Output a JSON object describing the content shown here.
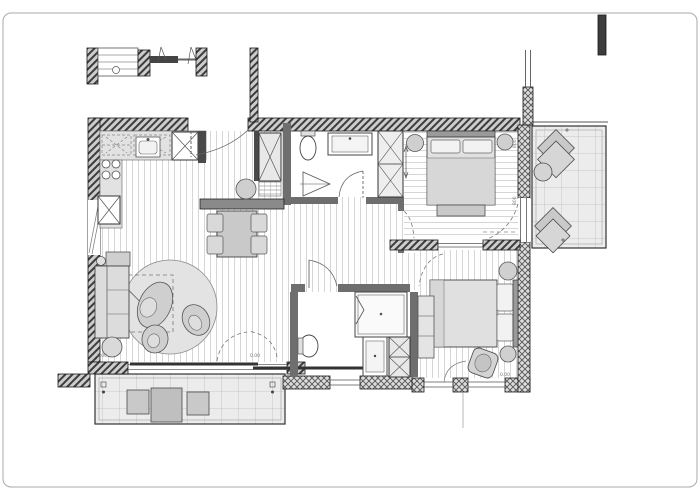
{
  "meta": {
    "drawing_type": "apartment floor plan",
    "sheet": {
      "border_color": "#aaaaaa",
      "background": "#ffffff"
    }
  },
  "palette": {
    "wall_hatch_dark": "#3d3d3d",
    "wall_hatch_bg": "#cdcdcd",
    "wall_interior": "#6e6e6e",
    "wall_outline": "#1a1a1a",
    "floor_stripe": "#d6d6d6",
    "tile_bg": "#ececec",
    "tile_line": "#bdbdbd",
    "furniture_fill": "#d6d6d6",
    "furniture_stroke": "#4a4a4a",
    "arc_stroke": "#666666"
  },
  "annotations": {
    "level_marker_living": "0.00",
    "level_marker_terrace": "0.00",
    "level_marker_bedroom2": "0.00",
    "door_width_balcony_1": "800",
    "door_width_balcony_2": "800"
  }
}
